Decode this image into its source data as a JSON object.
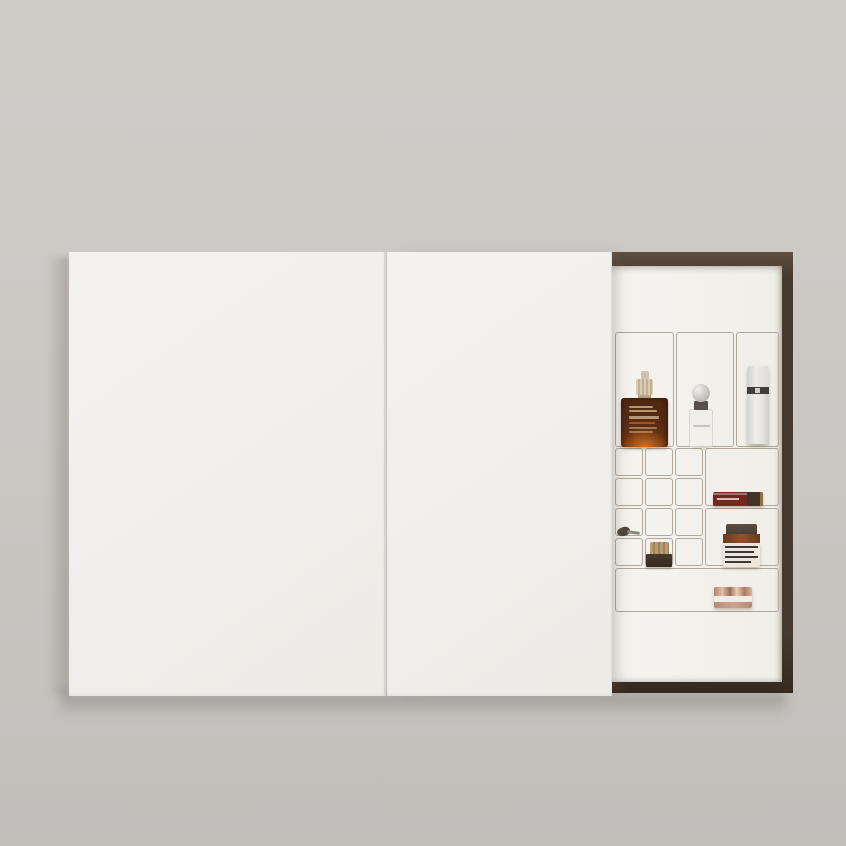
{
  "scene": {
    "type": "product-interior-photograph",
    "description": "Minimal wall-mounted bathroom cabinet with flat white sliding doors; right panel slid open revealing a dark walnut frame and a white wire grid organizer holding skincare and cosmetics",
    "visible_text_legible": false
  },
  "palette": {
    "wall_top": "#d0cdc9",
    "wall_mid": "#cac7c3",
    "wall_bottom": "#c2bfbb",
    "door": "#f1efeb",
    "door_seam": "#d7d4cf",
    "frame_top": "#5e4f41",
    "frame_mid": "#453a2f",
    "frame_dark": "#342a21",
    "interior": "#f6f4f0",
    "grid_line": "#b1a89b",
    "serum_glass": "#5a2c14",
    "serum_glow": "#e87a1e",
    "serum_cap": "#d8cbb2",
    "serum_accent": "#c2571f",
    "perfume_metal": "#cfccc8",
    "perfume_collar": "#57504a",
    "pump_body": "#efedea",
    "pump_band": "#413d39",
    "gloss_body": "#72271f",
    "gloss_cap": "#423528",
    "gloss_tip": "#8d7147",
    "jar_lid": "#4a3f37",
    "jar_glass": "#94502a",
    "jar_label": "#ece6dc",
    "jar_stripe": "#3c3833",
    "minijar_cap": "#b69b73",
    "minijar_base": "#34291f",
    "brush_dark": "#4e463e",
    "compact_metal": "#eccdb8",
    "compact_light": "#f1ebe5",
    "compact_blush": "#cda58f"
  },
  "cabinet": {
    "left_door": "closed sliding panel",
    "right_door": "sliding panel slid left, compartment exposed",
    "organizer": {
      "tall_cells": 3,
      "small_cells_left": 12,
      "wide_cells_right": 2,
      "bottom_shelf_cells": 1
    }
  },
  "products": [
    {
      "id": "serum-bottle",
      "name": "Amber glass serum bottle with ribbed cream dropper cap and orange glow base"
    },
    {
      "id": "perfume-bottle",
      "name": "Slim translucent perfume bottle with spherical metal cap"
    },
    {
      "id": "pump-bottle",
      "name": "White airless pump bottle with dark band"
    },
    {
      "id": "lip-gloss",
      "name": "Dark red lip gloss tube lying horizontally with gold tip"
    },
    {
      "id": "striped-jar",
      "name": "Amber jar with dark lid and striped cream label"
    },
    {
      "id": "mini-jar",
      "name": "Small jar with ribbed gold cap and dark base"
    },
    {
      "id": "makeup-brush",
      "name": "Small makeup brush lying flat"
    },
    {
      "id": "rose-compact",
      "name": "Rose-gold compact cream jar on bottom shelf"
    }
  ]
}
